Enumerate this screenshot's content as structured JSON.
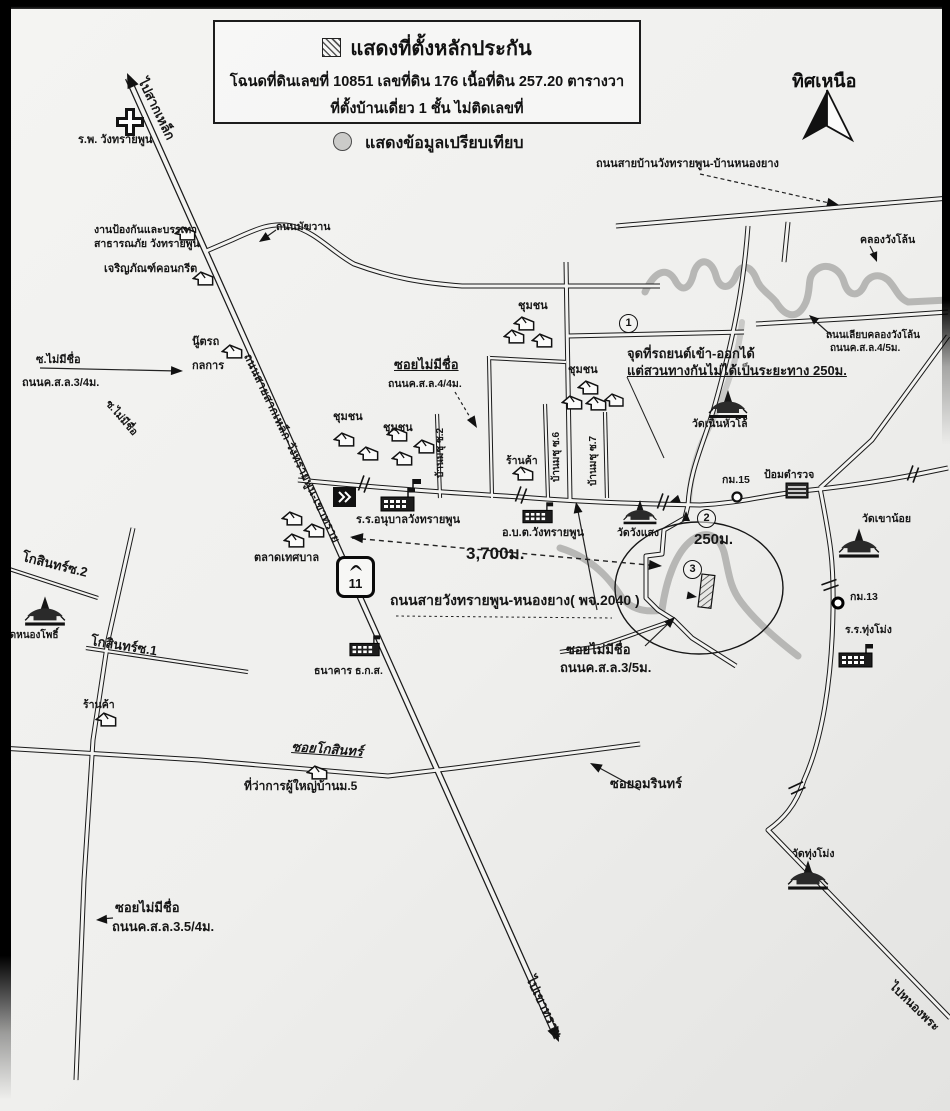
{
  "title_box": {
    "line1": "แสดงที่ตั้งหลักประกัน",
    "line2": "โฉนดที่ดินเลขที่ 10851 เลขที่ดิน 176 เนื้อที่ดิน 257.20 ตารางวา",
    "line3": "ที่ตั้งบ้านเดี่ยว 1  ชั้น ไม่ติดเลขที่"
  },
  "legend": {
    "compare": "แสดงข้อมูลเปรียบเทียบ"
  },
  "compass": {
    "north": "ทิศเหนือ"
  },
  "highway_shield": {
    "number": "11"
  },
  "markers": {
    "m1": "1",
    "m2": "2",
    "m3": "3"
  },
  "labels": {
    "hospital": "ร.พ. วังทรายพูน",
    "to_saklek": "ไปสากเหล็ก",
    "disaster1": "งานป้องกันและบรรเทา",
    "disaster2": "สาธารณภัย วังทรายพูน",
    "charoen": "เจริญภัณฑ์คอนกรีต",
    "makkhawan": "ถนนมัฆวาน",
    "garage1": "นู๊ตรถ",
    "garage2": "กลการ",
    "soi_nn_w": "ซ.ไม่มีชื่อ",
    "soi_nn_w_road": "ถนนค.ส.ล.3/4ม.",
    "soi_nn_w2": "ซ.ไม่มีชื่อ",
    "diag_road": "ถนนสายสากเหล็ก-วังทรายพูน-เขาทราย",
    "tr_road": "ถนนสายบ้านวังทรายพูน-บ้านหนองยาง",
    "khlong": "คลองวังโล้น",
    "khlong_rd1": "ถนนเลียบคลองวังโล้น",
    "khlong_rd2": "ถนนค.ส.ล.4/5ม.",
    "chumchon": "ชุมชน",
    "entry1": "จุดที่รถยนต์เข้า-ออกได้",
    "entry2": "แต่สวนทางกันไม่ได้เป็นระยะทาง 250ม.",
    "soi_mid": "ซอยไม่มีชื่อ",
    "soi_mid_rd": "ถนนค.ส.ล.4/4ม.",
    "soi2": "บ้านมชุ ซ.2",
    "soi6": "บ้านมชุ ซ.6",
    "soi7": "บ้านมชุ ซ.7",
    "shop": "ร้านค้า",
    "wat_noen": "วัดเนินหัวโล้",
    "km15": "กม.15",
    "police": "ป้อมตำรวจ",
    "wat_khaonoi": "วัดเขาน้อย",
    "km13": "กม.13",
    "school_tm": "ร.ร.ทุ่งโม่ง",
    "wat_tm": "วัดทุ่งโม่ง",
    "to_nongphra": "ไปหนองพระ",
    "school_anuban": "ร.ร.อนุบาลวังทรายพูน",
    "obt": "อ.บ.ต.วังทรายพูน",
    "wat_wangsaeng": "วัดวังแสง",
    "talad": "ตลาดเทศบาล",
    "d3700": "3,700ม.",
    "road2040": "ถนนสายวังทรายพูน-หนองยาง( พจ.2040 )",
    "d250": "250ม.",
    "soi35_1": "ซอยไม่มีชื่อ",
    "soi35_2": "ถนนค.ส.ล.3/5ม.",
    "bank": "ธนาคาร ธ.ก.ส.",
    "soi_kosin": "ซอยโกสินทร์",
    "phuyai": "ที่ว่าการผู้ใหญ่บ้านม.5",
    "soi_amarin": "ซอยอมรินทร์",
    "kosin2": "โกสินทร์ซ.2",
    "kosin1": "โกสินทร์ซ.1",
    "wat_nongpho": "วัดหนองโพธิ์",
    "soi354_1": "ซอยไม่มีชื่อ",
    "soi354_2": "ถนนค.ส.ล.3.5/4ม.",
    "to_khaosai": "ไปเขาทราย"
  }
}
